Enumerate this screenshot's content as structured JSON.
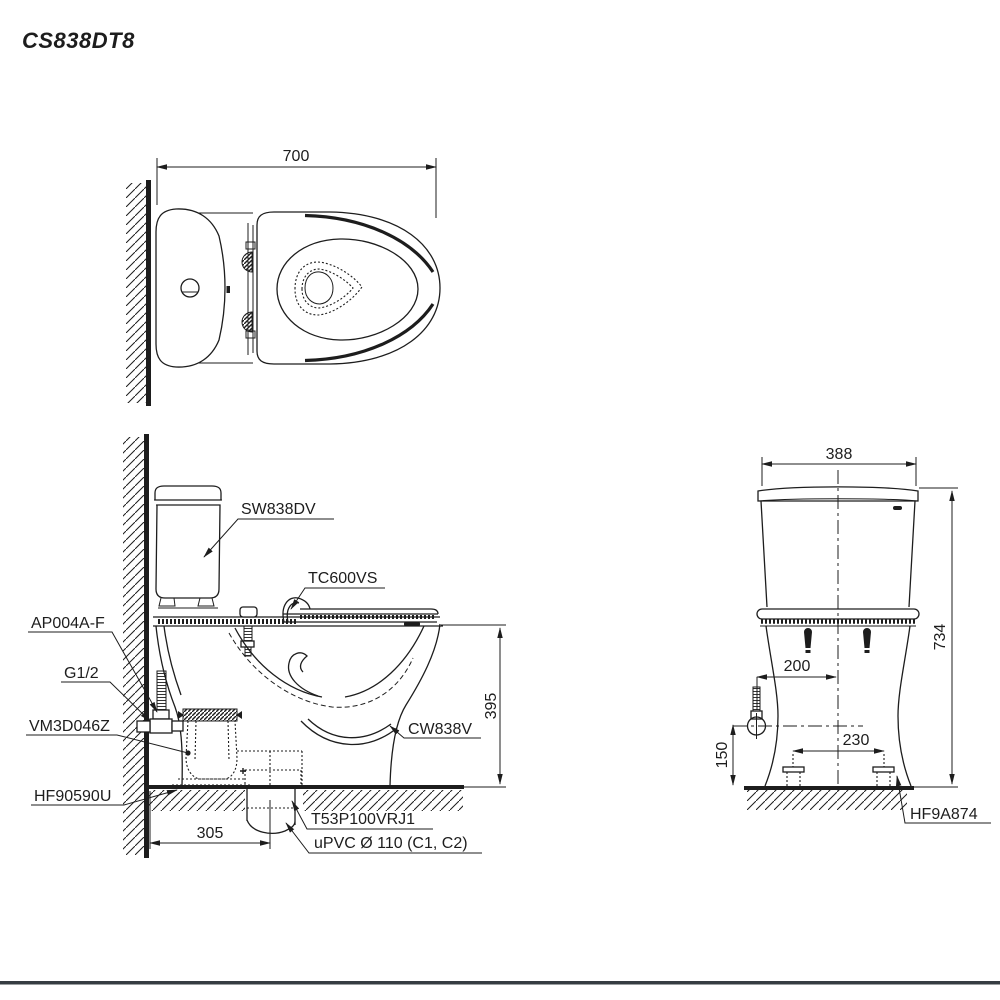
{
  "title": "CS838DT8",
  "top_view": {
    "width_dim": "700"
  },
  "side_view": {
    "dims": {
      "rim_height": "395",
      "outlet_setback": "305"
    },
    "labels": {
      "cistern": "SW838DV",
      "seat": "TC600VS",
      "supply_valve": "AP004A-F",
      "supply_thread": "G1/2",
      "flush_valve": "VM3D046Z",
      "floor_fixing": "HF90590U",
      "bowl": "CW838V",
      "outlet_flange": "T53P100VRJ1",
      "outlet_pipe": "uPVC Ø 110 (C1, C2)"
    }
  },
  "front_view": {
    "dims": {
      "width": "388",
      "height": "734",
      "supply_offset": "200",
      "bolt_spacing": "230",
      "supply_height": "150"
    },
    "labels": {
      "floor_fixing": "HF9A874"
    }
  },
  "colors": {
    "line": "#1d1d1d",
    "footer_bar": "#363c42",
    "background": "#ffffff"
  }
}
